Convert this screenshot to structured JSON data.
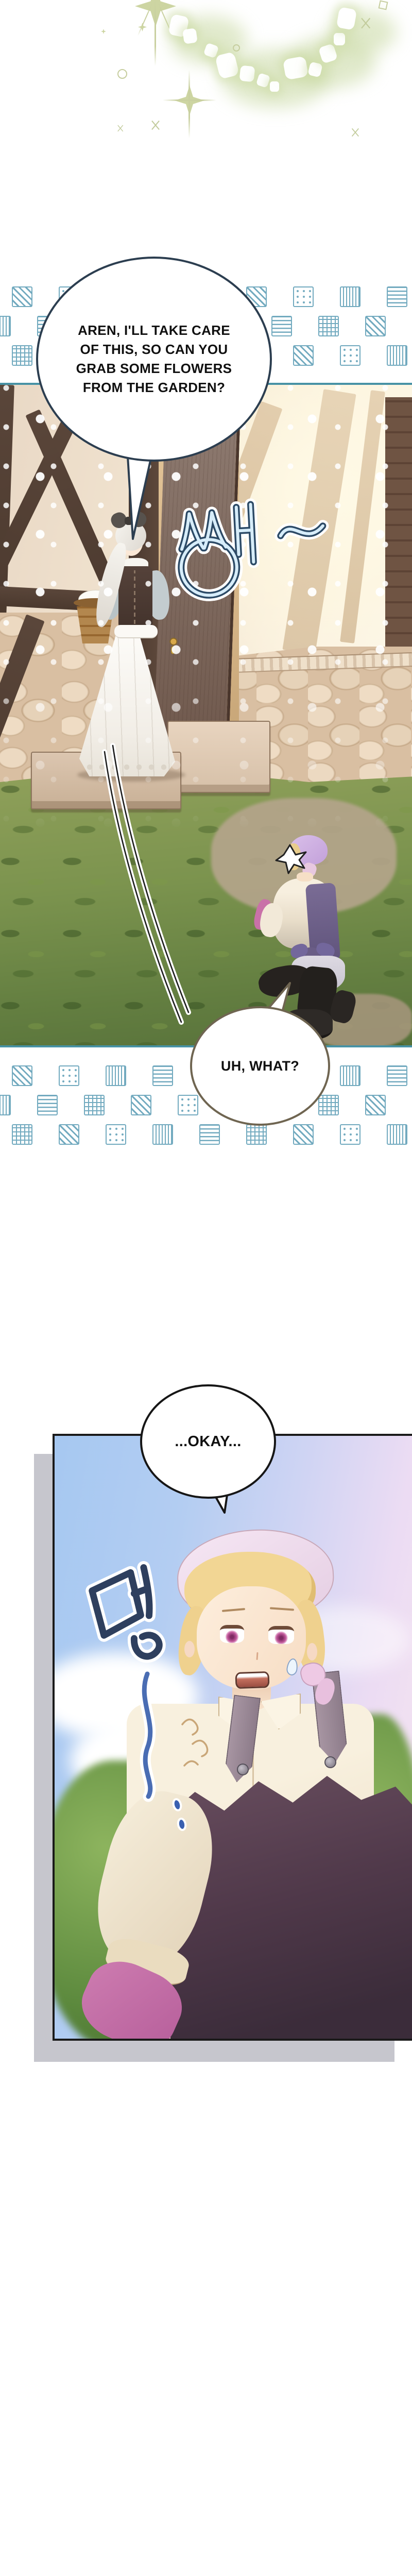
{
  "page": {
    "kind": "webtoon episode page",
    "background": "#ffffff"
  },
  "dialogue": {
    "bubble1": {
      "text": "AREN, I'LL TAKE CARE\nOF THIS, SO CAN YOU\nGRAB SOME FLOWERS\nFROM THE GARDEN?",
      "outline_color": "#2c3e50"
    },
    "bubble2": {
      "text": "UH, WHAT?",
      "outline_color": "#6f6551"
    },
    "bubble3": {
      "text": "...OKAY...",
      "outline_color": "#161616"
    }
  },
  "sfx": {
    "sseng": {
      "text": "썡~",
      "fill": "#d7edfa",
      "outline": "#2c4a66"
    },
    "meong": {
      "text": "멍",
      "fill": "#2e3f5e",
      "outline": "#ffffff"
    }
  },
  "decor": {
    "pattern_strip": {
      "stroke": "#72aabf",
      "patterns": [
        "diag",
        "dots",
        "vstripes",
        "hstripes",
        "grid"
      ],
      "rows": 3,
      "cols": 10
    },
    "panel1_border_color": "#4792a5",
    "panel2_border_color": "#1a1a1a",
    "panel2_shadow_color": "#c6c6cd",
    "sparkle_color": "#c9d0a0"
  },
  "scene_colors": {
    "grass": "#7b934e",
    "stone": "#d9bfa2",
    "timber": "#54423a",
    "door": "#8d7a70",
    "sky_blue": "#a6c8f1",
    "sky_pink": "#f6e6f1",
    "apron_plum": "#4e3a48",
    "apron_back": "#6a5d86",
    "kerchief_pink": "#f0dff0",
    "kerchief_lavender": "#cfb0e2",
    "glove_pink": "#c873aa",
    "hair_blonde": "#f2d694",
    "hair_white": "#f4f2ee",
    "eye_pink": "#c2599c"
  }
}
